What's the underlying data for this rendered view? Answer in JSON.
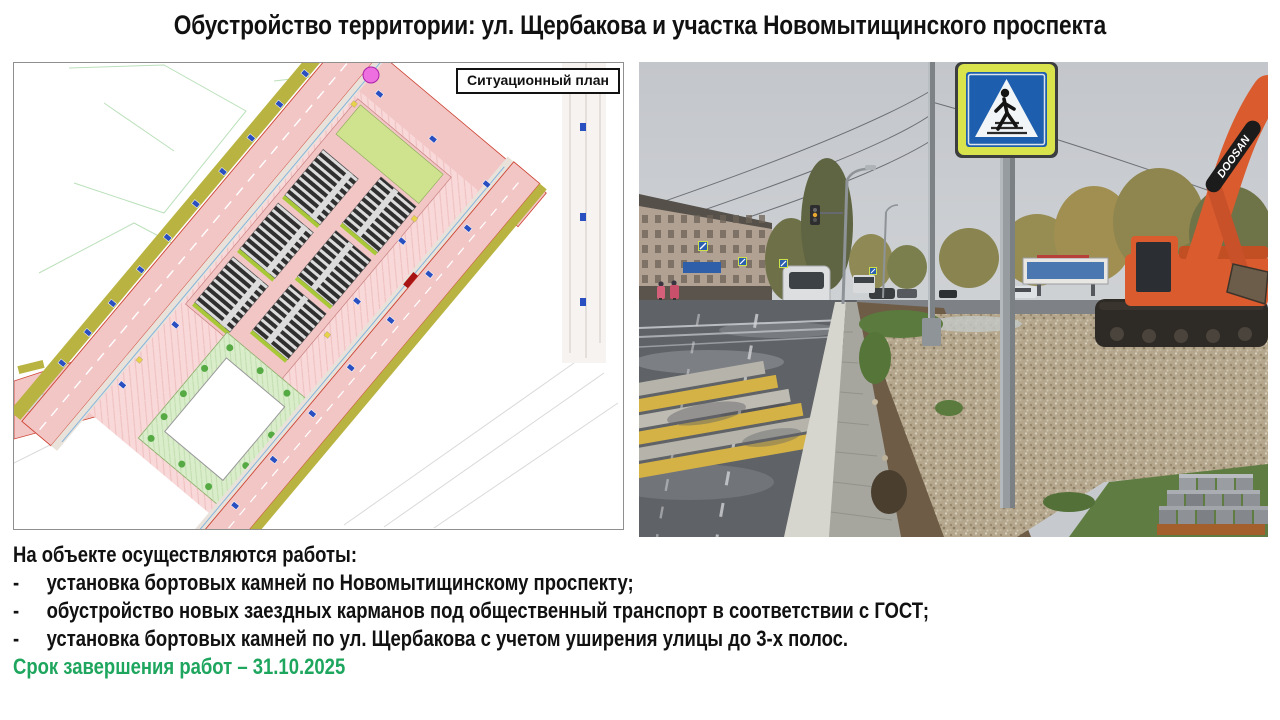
{
  "title": "Обустройство территории: ул. Щербакова и участка Новомытищинского проспекта",
  "plan": {
    "label": "Ситуационный план"
  },
  "photo": {
    "excavator_brand": "DOOSAN"
  },
  "work_list": {
    "heading": "На объекте осуществляются работы:",
    "items": [
      {
        "bullet": "-",
        "text": "установка бортовых камней по Новомытищинскому проспекту;"
      },
      {
        "bullet": "-",
        "text": "обустройство новых заездных карманов под общественный транспорт в соответствии с ГОСТ;"
      },
      {
        "bullet": "-",
        "text": "установка бортовых камней по ул. Щербакова с учетом уширения улицы до 3-х полос."
      }
    ],
    "deadline": "Срок завершения работ – 31.10.2025"
  },
  "theme": {
    "deadline_green": "#1ea65e",
    "plan_road_pink": "#f3c6c6",
    "sign_blue": "#1d5fae",
    "sign_fluor": "#d9e44c",
    "excavator_orange": "#d95b2e"
  }
}
